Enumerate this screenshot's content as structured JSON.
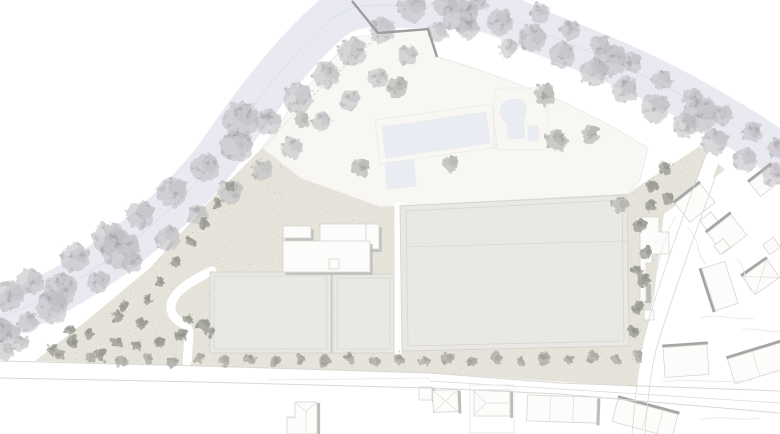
{
  "plan": {
    "kind": "architectural-site-plan",
    "width": 780,
    "height": 434
  },
  "colors": {
    "background": "#ffffff",
    "river": "#e9eaf1",
    "river_line": "#dfe0e9",
    "site_white": "#f8f7f4",
    "ground": "#e5e3da",
    "ground_speckle": "#a8a394",
    "roof": "#e9e8e4",
    "roof_speckle": "#97948c",
    "roof_edge": "#d6d5d0",
    "seam": "#c8c8c4",
    "building_white": "#fcfcfa",
    "white_outline": "#d4d4d1",
    "shadow": "#bcbcb9",
    "shadow_strong": "#a5a5a3",
    "house_outline": "#d6d6d3",
    "roofline": "#dcdcd9",
    "pool": "#eaecf3",
    "deck_line": "#e9e9e6",
    "road_line": "#d8d8d4",
    "parcel_line": "#e7e7e4",
    "dash_line": "#c9c9c6",
    "wall": "#9d9d9e",
    "tree_river": "#bcbcbf",
    "tree_area": "#adada9",
    "tree_dark": "#94958d",
    "tree_street": "#a2a29c"
  },
  "features": {
    "river": {
      "path": "M-15,322 C60,300 150,240 215,160 C245,115 290,55 330,20 C355,0 380,6 420,6 C465,6 485,5 530,28 C585,50 640,70 700,105 C735,125 765,142 795,168",
      "width": 44
    },
    "site_polygon": [
      [
        262,
        148
      ],
      [
        300,
        95
      ],
      [
        330,
        62
      ],
      [
        352,
        38
      ],
      [
        380,
        33
      ],
      [
        430,
        30
      ],
      [
        438,
        57
      ],
      [
        480,
        70
      ],
      [
        560,
        100
      ],
      [
        615,
        128
      ],
      [
        648,
        148
      ],
      [
        640,
        180
      ],
      [
        628,
        194
      ],
      [
        380,
        207
      ],
      [
        300,
        178
      ]
    ],
    "ground_polygon": [
      [
        35,
        361
      ],
      [
        85,
        322
      ],
      [
        150,
        268
      ],
      [
        215,
        195
      ],
      [
        262,
        148
      ],
      [
        300,
        178
      ],
      [
        380,
        207
      ],
      [
        628,
        194
      ],
      [
        648,
        180
      ],
      [
        700,
        146
      ],
      [
        725,
        170
      ],
      [
        664,
        214
      ],
      [
        654,
        296
      ],
      [
        643,
        345
      ],
      [
        640,
        387
      ],
      [
        430,
        373
      ],
      [
        200,
        366
      ]
    ],
    "white_paths": [
      {
        "d": "M212,271 C186,283 166,297 172,313 C176,324 190,322 189,336 L187,362",
        "w": 9
      },
      {
        "d": "M398,205 L398,352",
        "w": 7
      },
      {
        "d": "M712,160 C692,215 668,278 652,335 C646,356 642,392 638,434",
        "w": 14
      }
    ],
    "pools": [
      {
        "d": "M382,127 L486,112 L490,143 L386,158 Z"
      },
      {
        "d": "M385,163 L414,160 L416,186 L387,189 Z"
      },
      {
        "d": "M501,108 C501,98 523,95 526,106 C528,114 522,119 524,127 L525,138 L508,139 L507,122 C501,120 499,114 501,108 Z"
      },
      {
        "d": "M528,126 L537,126 C540,132 540,138 537,141 L528,141 Z"
      }
    ],
    "gray_buildings": [
      {
        "d": "M210,272 L331,272 L331,353 L210,353 Z"
      },
      {
        "d": "M333,274 L394,274 L394,353 L333,353 Z"
      },
      {
        "d": "M400,206 L627,195 L629,346 L402,351 Z"
      }
    ],
    "white_slabs": [
      {
        "x": 283,
        "y": 226,
        "w": 28,
        "h": 12
      },
      {
        "x": 320,
        "y": 224,
        "w": 46,
        "h": 29
      },
      {
        "x": 366,
        "y": 224,
        "w": 13,
        "h": 25
      },
      {
        "x": 283,
        "y": 241,
        "w": 87,
        "h": 31
      }
    ],
    "white_polygons": [
      {
        "d": "M640,217 L659,217 L659,232 L669,232 L669,254 L652,254 L652,263 L646,263 L646,301 L640,301 Z",
        "shadow_bar": [
          645,
          284,
          6,
          19
        ]
      },
      {
        "d": "M644,310 L654,310 L654,320 L644,320 Z"
      },
      {
        "d": "M329,259 L339,259 L339,269 L329,269 Z"
      },
      {
        "d": "M287,417 L295,417 L295,402 L317,402 L317,434 L287,434 Z",
        "shadow_line": "M318.6,403 L318.6,434"
      }
    ],
    "houses": [
      {
        "x": 419,
        "y": 387,
        "w": 13,
        "h": 13,
        "rot": 0,
        "shadow": "right"
      },
      {
        "x": 433,
        "y": 390,
        "w": 25,
        "h": 22,
        "rot": -2,
        "shadow": "right",
        "roof": "hipx"
      },
      {
        "x": 474,
        "y": 390,
        "w": 36,
        "h": 26,
        "rot": 0,
        "shadow": "right"
      },
      {
        "x": 527,
        "y": 396,
        "w": 70,
        "h": 26,
        "rot": 2,
        "shadow": "right",
        "div": [
          0.33,
          0.66
        ]
      },
      {
        "x": 614,
        "y": 406,
        "w": 62,
        "h": 24,
        "rot": 15,
        "shadow": "top",
        "div": [
          0.5,
          0.75
        ]
      },
      {
        "x": 664,
        "y": 346,
        "w": 44,
        "h": 30,
        "rot": -4,
        "shadow": "top"
      },
      {
        "x": 730,
        "y": 350,
        "w": 58,
        "h": 26,
        "rot": -17,
        "shadow": "top",
        "div": [
          0.45
        ]
      },
      {
        "x": 679,
        "y": 191,
        "w": 32,
        "h": 24,
        "rot": -38,
        "shadow": "top"
      },
      {
        "x": 702,
        "y": 215,
        "w": 14,
        "h": 12,
        "rot": -38,
        "shadow": "none"
      },
      {
        "x": 712,
        "y": 221,
        "w": 30,
        "h": 26,
        "rot": -38,
        "shadow": "top"
      },
      {
        "x": 716,
        "y": 241,
        "w": 12,
        "h": 11,
        "rot": -38,
        "shadow": "none"
      },
      {
        "x": 708,
        "y": 264,
        "w": 24,
        "h": 44,
        "rot": -18,
        "shadow": "left"
      },
      {
        "x": 746,
        "y": 266,
        "w": 30,
        "h": 22,
        "rot": -35,
        "shadow": "top",
        "roof": "hipx"
      },
      {
        "x": 765,
        "y": 240,
        "w": 13,
        "h": 12,
        "rot": -35,
        "shadow": "none"
      },
      {
        "x": 752,
        "y": 172,
        "w": 28,
        "h": 18,
        "rot": -38,
        "shadow": "top"
      }
    ],
    "lines": [
      {
        "d": "M0,361 L200,366 L430,373 L560,383 L780,391",
        "c": "road_line",
        "w": 1
      },
      {
        "d": "M0,378 L200,382 L430,388 L560,394 L780,413",
        "c": "road_line",
        "w": 1
      },
      {
        "d": "M430,381 L560,389 L780,403",
        "c": "road_line",
        "w": 0.7
      },
      {
        "d": "M268,380 L430,378",
        "c": "parcel_line",
        "w": 0.7
      },
      {
        "d": "M705,155 C686,210 662,272 646,330 C640,352 636,390 632,434",
        "c": "road_line",
        "w": 0.8
      },
      {
        "d": "M719,166 C700,222 676,284 659,340 C652,360 648,394 645,434",
        "c": "road_line",
        "w": 0.8
      },
      {
        "d": "M676,216 C666,232 660,252 658,270",
        "c": "parcel_line",
        "w": 0.8
      },
      {
        "d": "M688,228 C700,238 696,256 706,264",
        "c": "parcel_line",
        "w": 0.8
      },
      {
        "d": "M736,258 C748,268 742,282 752,292",
        "c": "parcel_line",
        "w": 0.8
      },
      {
        "d": "M700,318 C720,312 736,322 754,318",
        "c": "parcel_line",
        "w": 0.8
      },
      {
        "d": "M742,330 C756,326 768,334 780,331",
        "c": "parcel_line",
        "w": 0.8
      },
      {
        "d": "M662,382 C690,378 720,384 752,380",
        "c": "parcel_line",
        "w": 0.8
      },
      {
        "d": "M700,420 C720,414 740,422 760,418",
        "c": "parcel_line",
        "w": 0.8
      },
      {
        "d": "M295,112 L378,36",
        "c": "dash_line",
        "w": 0.8,
        "dash": "2.5,2.5"
      },
      {
        "d": "M262,150 L296,112",
        "c": "parcel_line",
        "w": 0.8
      },
      {
        "d": "M330,62 L352,38",
        "c": "parcel_line",
        "w": 0.8
      },
      {
        "d": "M438,57 L472,68",
        "c": "parcel_line",
        "w": 0.8
      },
      {
        "d": "M375,120 L492,104 L497,147 L380,164 Z",
        "c": "deck_line",
        "w": 0.8
      },
      {
        "d": "M494,96 Q494,88 502,88 L540,88 Q548,88 548,96 L548,142 Q548,150 540,150 L502,150 Q494,150 494,142 Z",
        "c": "deck_line",
        "w": 0.8
      },
      {
        "d": "M406,211 L622,200 L624,341 L408,346 Z",
        "c": "roof_edge",
        "w": 0.8
      },
      {
        "d": "M403,247 L627,241",
        "c": "roof_edge",
        "w": 0.6
      },
      {
        "d": "M214,276 L327,276 L327,349 L214,349 Z",
        "c": "roof_edge",
        "w": 0.7
      },
      {
        "d": "M337,278 L390,278 L390,349 L337,349 Z",
        "c": "roof_edge",
        "w": 0.7
      },
      {
        "d": "M331.5,274 L331.5,353",
        "c": "seam",
        "w": 1
      },
      {
        "d": "M306,411 L306,434",
        "c": "roofline",
        "w": 0.7
      },
      {
        "d": "M296,403 L306,411 M316,403 L306,411",
        "c": "roofline",
        "w": 0.7
      },
      {
        "d": "M287,418 L295,418",
        "c": "roofline",
        "w": 0.7
      },
      {
        "d": "M474,391 L486,403 L474,415 M486,403 L509,403",
        "c": "roofline",
        "w": 0.7
      },
      {
        "d": "M470,385 L514,385 L514,433 L470,433 Z",
        "c": "parcel_line",
        "w": 0.8
      }
    ],
    "wall": {
      "d": "M352,1 L378,33 L428,29 L437,57",
      "w": 2.4
    },
    "trees_river": [
      [
        8,
        296,
        15
      ],
      [
        0,
        330,
        12
      ],
      [
        10,
        335,
        11
      ],
      [
        28,
        322,
        10
      ],
      [
        5,
        352,
        9
      ],
      [
        20,
        344,
        8
      ],
      [
        30,
        282,
        13
      ],
      [
        52,
        307,
        16
      ],
      [
        60,
        290,
        17
      ],
      [
        75,
        258,
        14
      ],
      [
        98,
        282,
        11
      ],
      [
        108,
        238,
        16
      ],
      [
        120,
        250,
        19
      ],
      [
        132,
        262,
        10
      ],
      [
        140,
        215,
        14
      ],
      [
        168,
        238,
        12
      ],
      [
        172,
        192,
        15
      ],
      [
        198,
        215,
        10
      ],
      [
        205,
        168,
        14
      ],
      [
        230,
        192,
        12
      ],
      [
        237,
        146,
        16
      ],
      [
        240,
        120,
        18
      ],
      [
        262,
        170,
        10
      ],
      [
        268,
        122,
        13
      ],
      [
        292,
        148,
        11
      ],
      [
        298,
        98,
        15
      ],
      [
        322,
        122,
        10
      ],
      [
        326,
        75,
        13
      ],
      [
        350,
        100,
        10
      ],
      [
        352,
        52,
        14
      ],
      [
        378,
        78,
        10
      ],
      [
        382,
        30,
        13
      ],
      [
        408,
        55,
        10
      ],
      [
        412,
        8,
        14
      ],
      [
        438,
        32,
        10
      ],
      [
        445,
        4,
        12
      ],
      [
        460,
        15,
        17
      ],
      [
        468,
        28,
        11
      ],
      [
        478,
        2,
        10
      ],
      [
        500,
        22,
        13
      ],
      [
        508,
        48,
        9
      ],
      [
        532,
        38,
        14
      ],
      [
        540,
        14,
        10
      ],
      [
        562,
        55,
        13
      ],
      [
        570,
        30,
        10
      ],
      [
        594,
        72,
        14
      ],
      [
        600,
        45,
        10
      ],
      [
        610,
        60,
        16
      ],
      [
        625,
        90,
        13
      ],
      [
        632,
        62,
        10
      ],
      [
        655,
        108,
        14
      ],
      [
        662,
        80,
        10
      ],
      [
        685,
        125,
        12
      ],
      [
        692,
        98,
        10
      ],
      [
        700,
        115,
        17
      ],
      [
        715,
        142,
        13
      ],
      [
        722,
        115,
        10
      ],
      [
        745,
        160,
        12
      ],
      [
        752,
        132,
        10
      ],
      [
        772,
        175,
        11
      ],
      [
        778,
        148,
        10
      ]
    ],
    "trees_area": [
      [
        397,
        87,
        10
      ],
      [
        360,
        168,
        9
      ],
      [
        450,
        164,
        8
      ],
      [
        545,
        95,
        11
      ],
      [
        556,
        140,
        11
      ],
      [
        590,
        134,
        9
      ],
      [
        302,
        120,
        8
      ],
      [
        620,
        205,
        8
      ]
    ],
    "trees_dark": [
      [
        118,
        317,
        6
      ],
      [
        140,
        323,
        6
      ],
      [
        124,
        306,
        5
      ],
      [
        73,
        342,
        6
      ],
      [
        52,
        350,
        5
      ],
      [
        100,
        355,
        6
      ],
      [
        137,
        347,
        5
      ],
      [
        117,
        342,
        6
      ],
      [
        182,
        335,
        6
      ],
      [
        203,
        325,
        6
      ],
      [
        188,
        320,
        5
      ],
      [
        147,
        300,
        5
      ],
      [
        160,
        282,
        5
      ],
      [
        176,
        262,
        5
      ],
      [
        190,
        242,
        5
      ],
      [
        204,
        224,
        5
      ],
      [
        218,
        204,
        5
      ],
      [
        230,
        186,
        5
      ],
      [
        70,
        330,
        5
      ],
      [
        88,
        333,
        5
      ],
      [
        160,
        342,
        5
      ],
      [
        210,
        332,
        5
      ],
      [
        640,
        225,
        7
      ],
      [
        646,
        252,
        6
      ],
      [
        643,
        280,
        7
      ],
      [
        638,
        308,
        6
      ],
      [
        633,
        332,
        6
      ],
      [
        650,
        205,
        6
      ],
      [
        637,
        270,
        5
      ],
      [
        665,
        168,
        7
      ],
      [
        652,
        186,
        6
      ],
      [
        668,
        198,
        6
      ]
    ],
    "trees_street": [
      [
        60,
        354,
        5
      ],
      [
        90,
        357,
        5
      ],
      [
        122,
        361,
        6
      ],
      [
        148,
        359,
        5
      ],
      [
        173,
        362,
        6
      ],
      [
        199,
        358,
        5
      ],
      [
        224,
        361,
        6
      ],
      [
        250,
        359,
        5
      ],
      [
        275,
        362,
        6
      ],
      [
        300,
        359,
        5
      ],
      [
        325,
        361,
        6
      ],
      [
        350,
        358,
        5
      ],
      [
        375,
        361,
        5
      ],
      [
        400,
        359,
        6
      ],
      [
        424,
        361,
        5
      ],
      [
        448,
        358,
        6
      ],
      [
        472,
        361,
        5
      ],
      [
        496,
        358,
        6
      ],
      [
        520,
        361,
        5
      ],
      [
        544,
        358,
        6
      ],
      [
        568,
        360,
        5
      ],
      [
        592,
        357,
        6
      ],
      [
        616,
        359,
        5
      ],
      [
        638,
        356,
        6
      ]
    ]
  }
}
